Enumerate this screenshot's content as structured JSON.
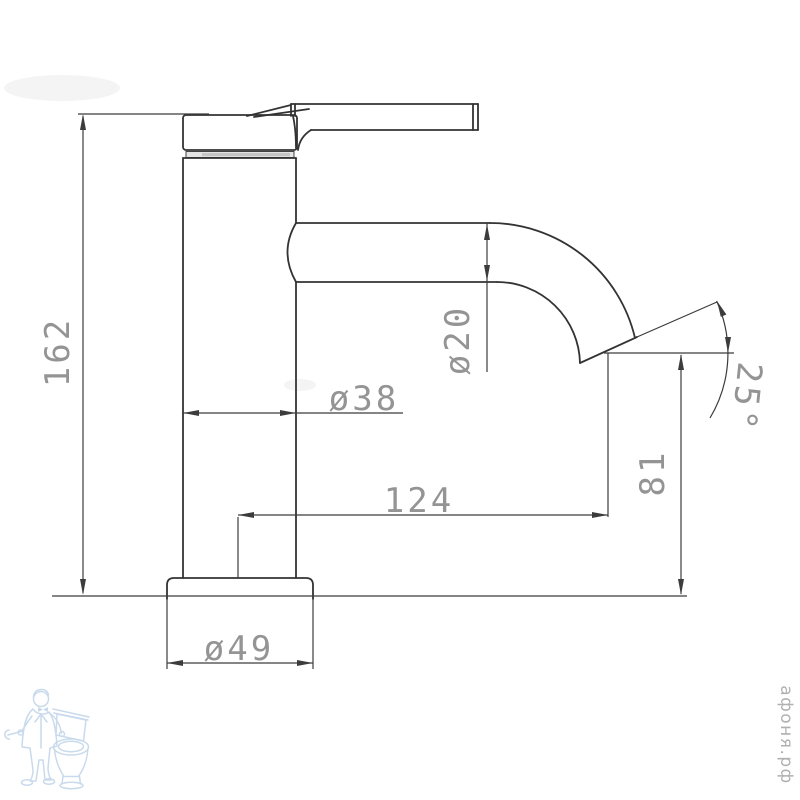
{
  "dimensions": {
    "total_height": "162",
    "body_diameter": "ø38",
    "spout_diameter": "ø20",
    "spout_reach": "124",
    "outlet_height": "81",
    "outlet_angle": "25°",
    "base_diameter": "ø49"
  },
  "watermark": {
    "site_label": "афоня.рф",
    "logo_icon": "plumber-with-toilet-icon"
  },
  "colors": {
    "background": "#ffffff",
    "outline": "#333333",
    "dimension_line": "#3c3c3c",
    "dimension_text": "#949494",
    "watermark_blue": "#a6c3e0",
    "site_text": "#b0b0b0"
  }
}
